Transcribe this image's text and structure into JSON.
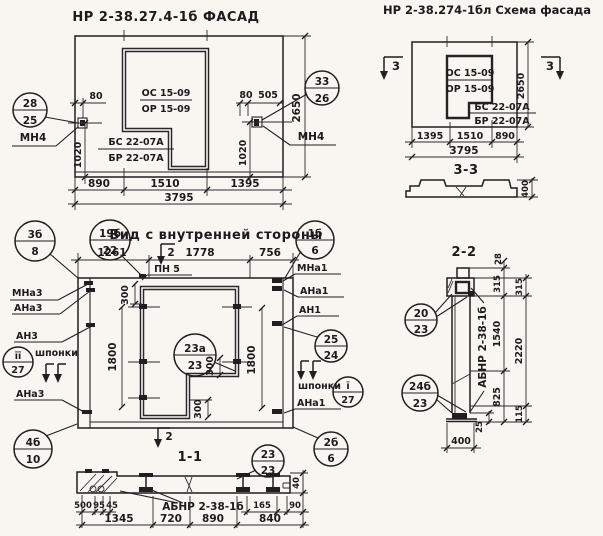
{
  "facade": {
    "title": "НР 2-38.27.4-1б ФАСАД",
    "window_mark_line1": "ОС 15-09",
    "window_mark_line2": "ОР 15-09",
    "sill_mark_line1": "БС 22-07А",
    "sill_mark_line2": "БР 22-07А",
    "anchor_label_left": "МН4",
    "anchor_label_right": "МН4",
    "callout_left": {
      "top": "28",
      "bottom": "25"
    },
    "callout_right": {
      "top": "33",
      "bottom": "26"
    },
    "dims": {
      "offset_left": "80",
      "offset_right": "80",
      "offset_right2": "505",
      "height_left": "1020",
      "height_right": "1020",
      "panel_height": "2650",
      "bottom_segments": [
        "890",
        "1510",
        "1395"
      ],
      "bottom_total": "3795"
    }
  },
  "schema": {
    "title": "НР 2-38.274-1бл Схема фасада",
    "window_mark_line1": "ОС 15-09",
    "window_mark_line2": "ОР 15-09",
    "sill_mark_line1": "БС 22-07А",
    "sill_mark_line2": "БР 22-07А",
    "section_mark_left": "3",
    "section_mark_right": "3",
    "dims": {
      "panel_height": "2650",
      "bottom_segments": [
        "1395",
        "1510",
        "890"
      ],
      "bottom_total": "3795"
    }
  },
  "section_3_3": {
    "title": "3-3",
    "dim_height": "400"
  },
  "inner_view": {
    "title": "Вид с внутренней стороны",
    "pn_label": "ПН 5",
    "shponki_left": "шпонки",
    "shponki_right": "шпонки",
    "section_mark_top": "2",
    "section_mark_bottom": "2",
    "callouts": {
      "c3b_8": {
        "top": "3б",
        "bottom": "8"
      },
      "c19b_22": {
        "top": "19б",
        "bottom": "22"
      },
      "c1b_6": {
        "top": "1б",
        "bottom": "6"
      },
      "c23a_23": {
        "top": "23а",
        "bottom": "23"
      },
      "c25_24": {
        "top": "25",
        "bottom": "24"
      },
      "ci_27": {
        "top": "ī",
        "bottom": "27"
      },
      "cii_27": {
        "top": "īī",
        "bottom": "27"
      },
      "c4b_10": {
        "top": "4б",
        "bottom": "10"
      },
      "c2b_6": {
        "top": "2б",
        "bottom": "6"
      },
      "c23_23": {
        "top": "23",
        "bottom": "23"
      }
    },
    "labels_left": [
      "МНа3",
      "АНа3",
      "АН3",
      "АНа3"
    ],
    "labels_right": [
      "МНа1",
      "АНа1",
      "АН1",
      "АНа1"
    ],
    "dims": {
      "top_segments": [
        "1261",
        "1778",
        "756"
      ],
      "d300_top": "300",
      "d300_step": "300",
      "d300_leg": "300",
      "height_left": "1800",
      "height_right": "1800"
    }
  },
  "section_1_1": {
    "title": "1-1",
    "item_label": "АБНР 2-38-1б",
    "dims": {
      "small_left": [
        "500",
        "95",
        "45"
      ],
      "small_right": [
        "165",
        "90"
      ],
      "bottom": [
        "1345",
        "720",
        "890",
        "840"
      ],
      "thickness": "40"
    }
  },
  "section_2_2": {
    "title": "2-2",
    "item_label": "АБНР 2-38-1б",
    "callout_top": {
      "top": "20",
      "bottom": "23"
    },
    "callout_bottom": {
      "top": "24б",
      "bottom": "23"
    },
    "dims": {
      "col_a": [
        "28",
        "315",
        "1540",
        "825"
      ],
      "col_b": [
        "315",
        "2220",
        "115"
      ],
      "base_thickness": "25",
      "width": "400"
    }
  }
}
